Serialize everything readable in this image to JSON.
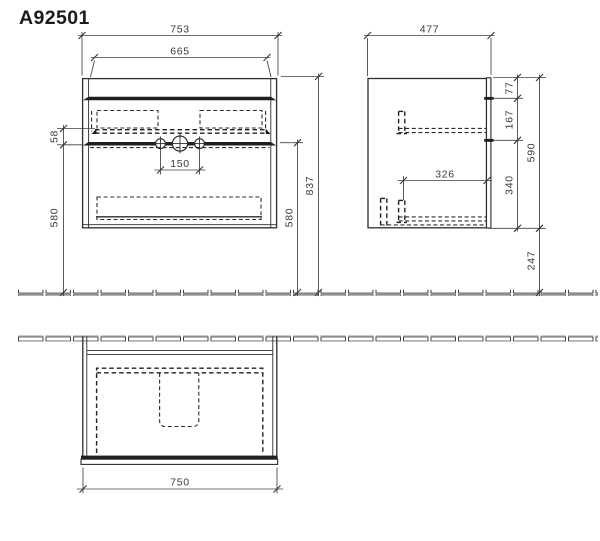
{
  "title": "A92501",
  "colors": {
    "background": "#ffffff",
    "line": "#2d2d2d",
    "dim_line": "#404040",
    "dim_text": "#3a3a3a",
    "title_text": "#1b1b1b"
  },
  "dims": {
    "front_width": "753",
    "front_inner_width": "665",
    "front_tap_spacing": "150",
    "front_lip": "58",
    "front_left_height": "580",
    "front_right_height": "580",
    "front_total_height": "837",
    "side_depth": "477",
    "side_top": "77",
    "side_upper_drawer": "167",
    "side_height": "590",
    "side_lower_drawer": "340",
    "side_floor_clearance": "247",
    "side_inner_depth": "326",
    "plan_width": "750"
  }
}
